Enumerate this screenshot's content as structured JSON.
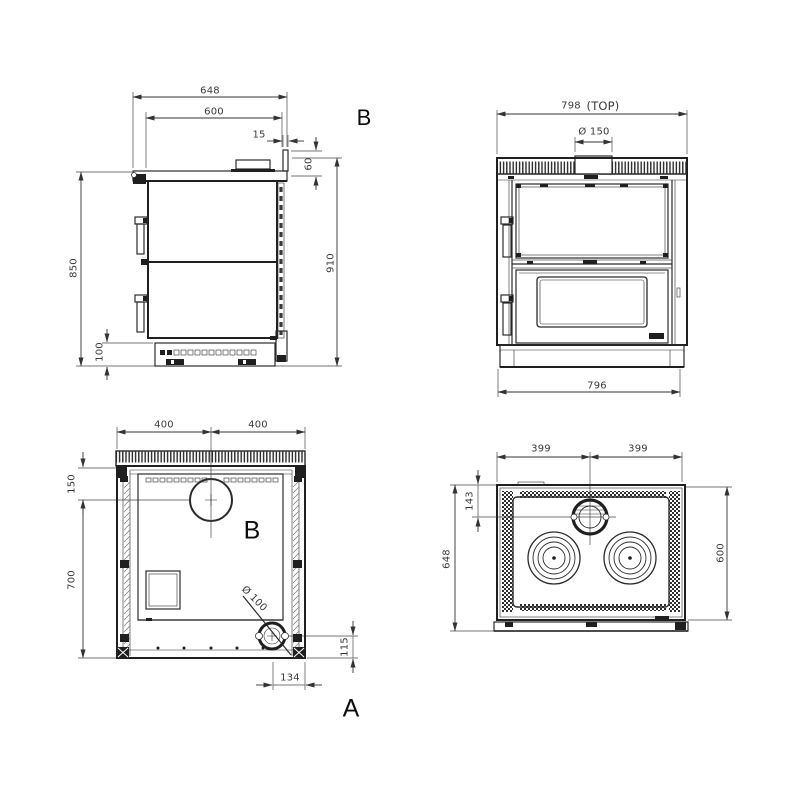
{
  "drawing_title": "stove-dimension-drawing",
  "colors": {
    "line": "#2b2b2b",
    "dim_text": "#3a3a3a",
    "label_text": "#0d0d0d",
    "background": "#ffffff"
  },
  "views": {
    "side": {
      "label": "B",
      "dims": {
        "overall_depth": "648",
        "top_depth": "600",
        "upstand_thickness": "15",
        "upstand_height": "60",
        "body_height": "850",
        "overall_height": "910",
        "plinth_height": "100"
      }
    },
    "front": {
      "dims": {
        "top_width": "798",
        "top_note": "(TOP)",
        "flue_diameter": "Ø 150",
        "base_width": "796"
      }
    },
    "rear": {
      "label_center": "B",
      "label_corner": "A",
      "dims": {
        "half_width_left": "400",
        "half_width_right": "400",
        "flue_top_offset": "150",
        "lower_height": "700",
        "port_diameter": "Ø 100",
        "port_height": "115",
        "port_side_offset": "134"
      }
    },
    "top": {
      "dims": {
        "half_width_left": "399",
        "half_width_right": "399",
        "flue_front_offset": "143",
        "overall_depth": "648",
        "inner_depth": "600"
      }
    }
  }
}
